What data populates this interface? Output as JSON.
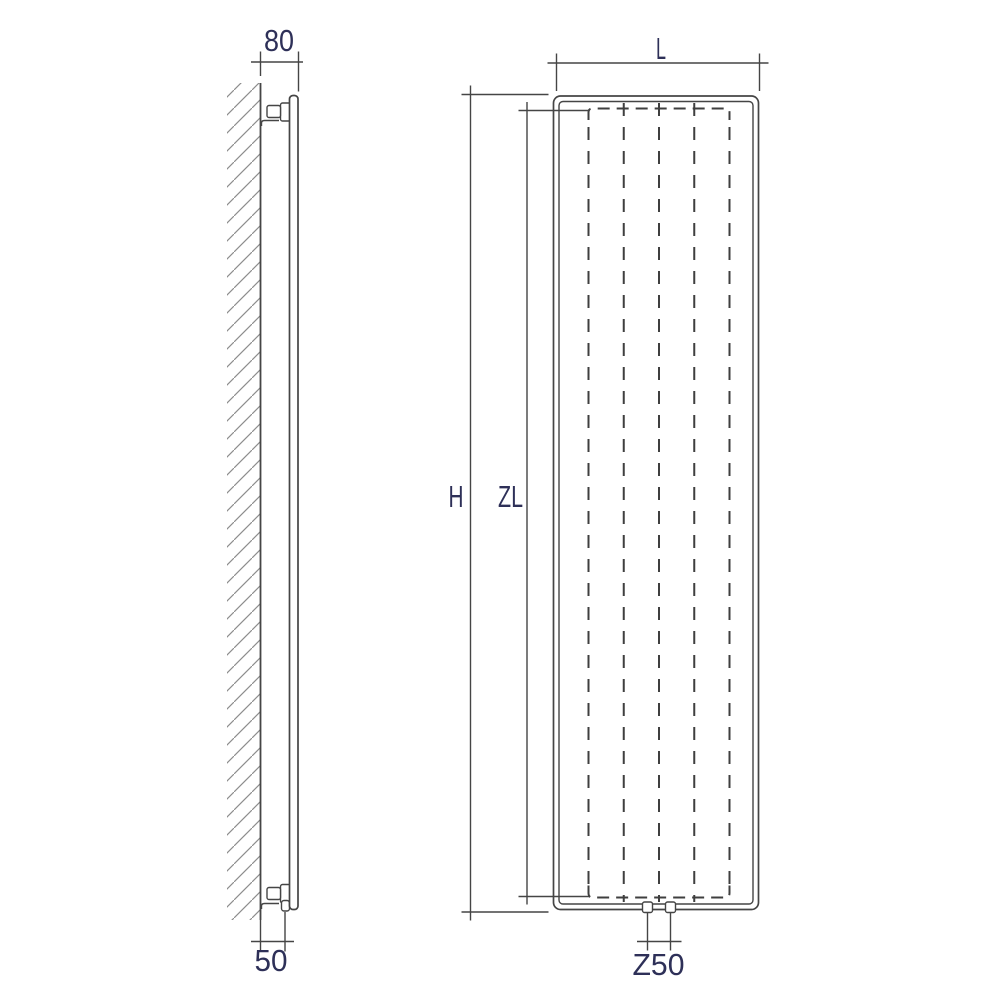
{
  "colors": {
    "background": "#ffffff",
    "line": "#454545",
    "fin": "#3f3f3f",
    "hatch": "#8d8d8d",
    "label": "#2e3058"
  },
  "dimensions": {
    "depth": "80",
    "wall_to_connection": "50",
    "overall_height": "H",
    "element_height": "ZL",
    "overall_width": "L",
    "connection_spacing": "Z50"
  }
}
